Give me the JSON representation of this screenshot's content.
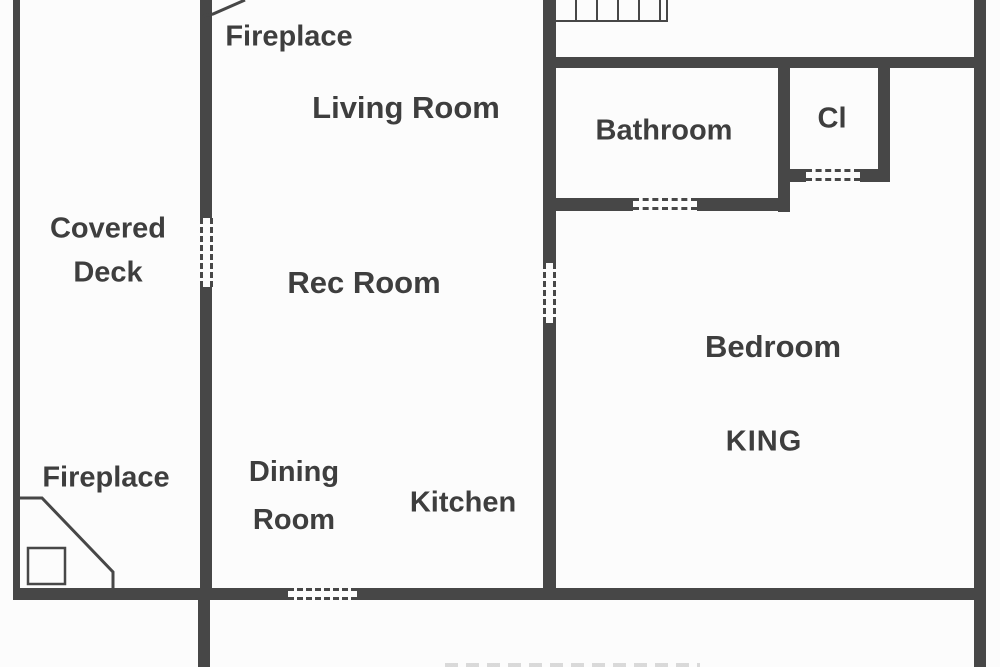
{
  "colors": {
    "wall": "#474747",
    "text": "#3e3e3e",
    "background": "#fcfcfc"
  },
  "rooms": {
    "covered_deck": {
      "line1": "Covered",
      "line2": "Deck"
    },
    "living_room": {
      "label": "Living Room"
    },
    "rec_room": {
      "label": "Rec Room"
    },
    "dining_room": {
      "line1": "Dining",
      "line2": "Room"
    },
    "kitchen": {
      "label": "Kitchen"
    },
    "bathroom": {
      "label": "Bathroom"
    },
    "closet": {
      "label": "Cl"
    },
    "bedroom": {
      "label": "Bedroom",
      "bed_type": "KING"
    }
  },
  "features": {
    "fireplace_upper": {
      "label": "Fireplace"
    },
    "fireplace_lower": {
      "label": "Fireplace"
    },
    "stairs": {
      "tread_count": 6
    }
  }
}
